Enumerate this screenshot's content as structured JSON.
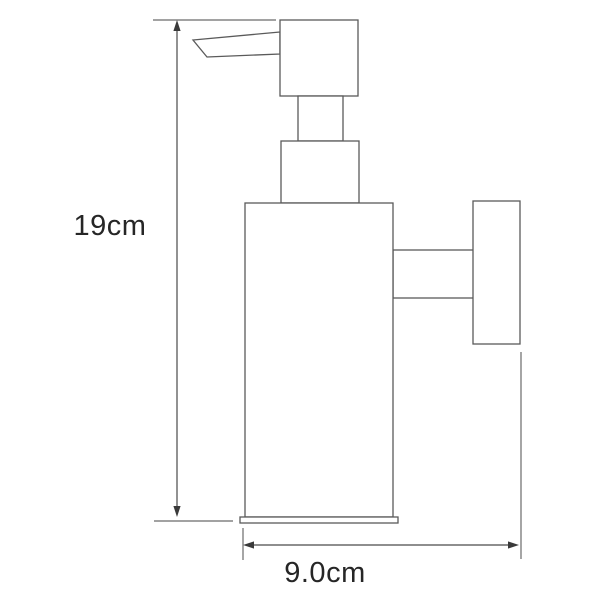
{
  "diagram": {
    "type": "technical-dimension-drawing",
    "subject": "wall-mounted-soap-dispenser-side-view",
    "dimensions": [
      {
        "id": "height",
        "label": "19cm",
        "orientation": "vertical"
      },
      {
        "id": "depth",
        "label": "9.0cm",
        "orientation": "horizontal"
      }
    ],
    "parts": [
      "pump-spout",
      "pump-head",
      "pump-neck",
      "pump-collar",
      "bottle-body",
      "base-plate",
      "mount-arm",
      "wall-plate"
    ]
  },
  "colors": {
    "background": "#ffffff",
    "outline_stroke": "#5a5a5a",
    "dimension_stroke": "#4a4a4a",
    "text": "#262626"
  }
}
